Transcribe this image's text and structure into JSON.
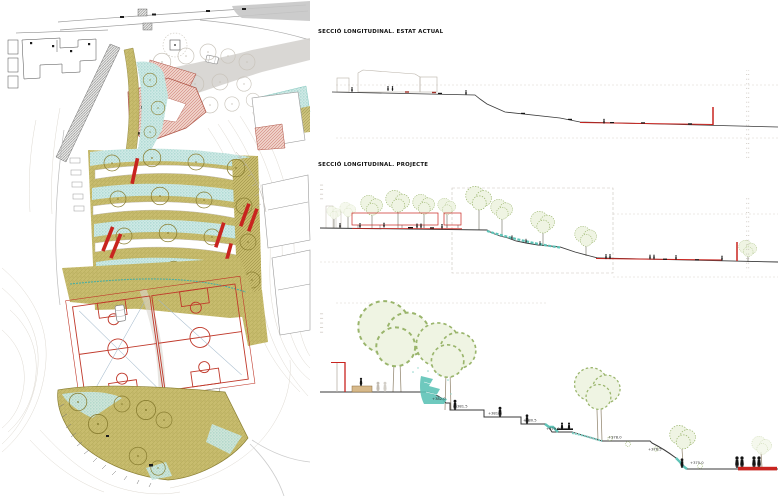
{
  "sheet": {
    "title": "landscape plan and longitudinal sections"
  },
  "sections": {
    "actual": {
      "title": "SECCIÓ LONGITUDINAL. ESTAT ACTUAL"
    },
    "project": {
      "title": "SECCIÓ LONGITUDINAL. PROJECTE"
    },
    "detail": {
      "elevation_labels": [
        "+382.0",
        "+381.5",
        "+381.0",
        "+380.5",
        "+379.0",
        "+378.0",
        "+376.5",
        "+375.0"
      ]
    }
  },
  "colors": {
    "accent_red": "#c8241f",
    "water_teal": "#49ada1",
    "vegetation_olive": "#c8bc6e",
    "terrace_pink": "#eed0c7",
    "tree_green": "#9ab56c",
    "ink": "#3a3a3a",
    "contour_gray": "#ded9d1"
  }
}
